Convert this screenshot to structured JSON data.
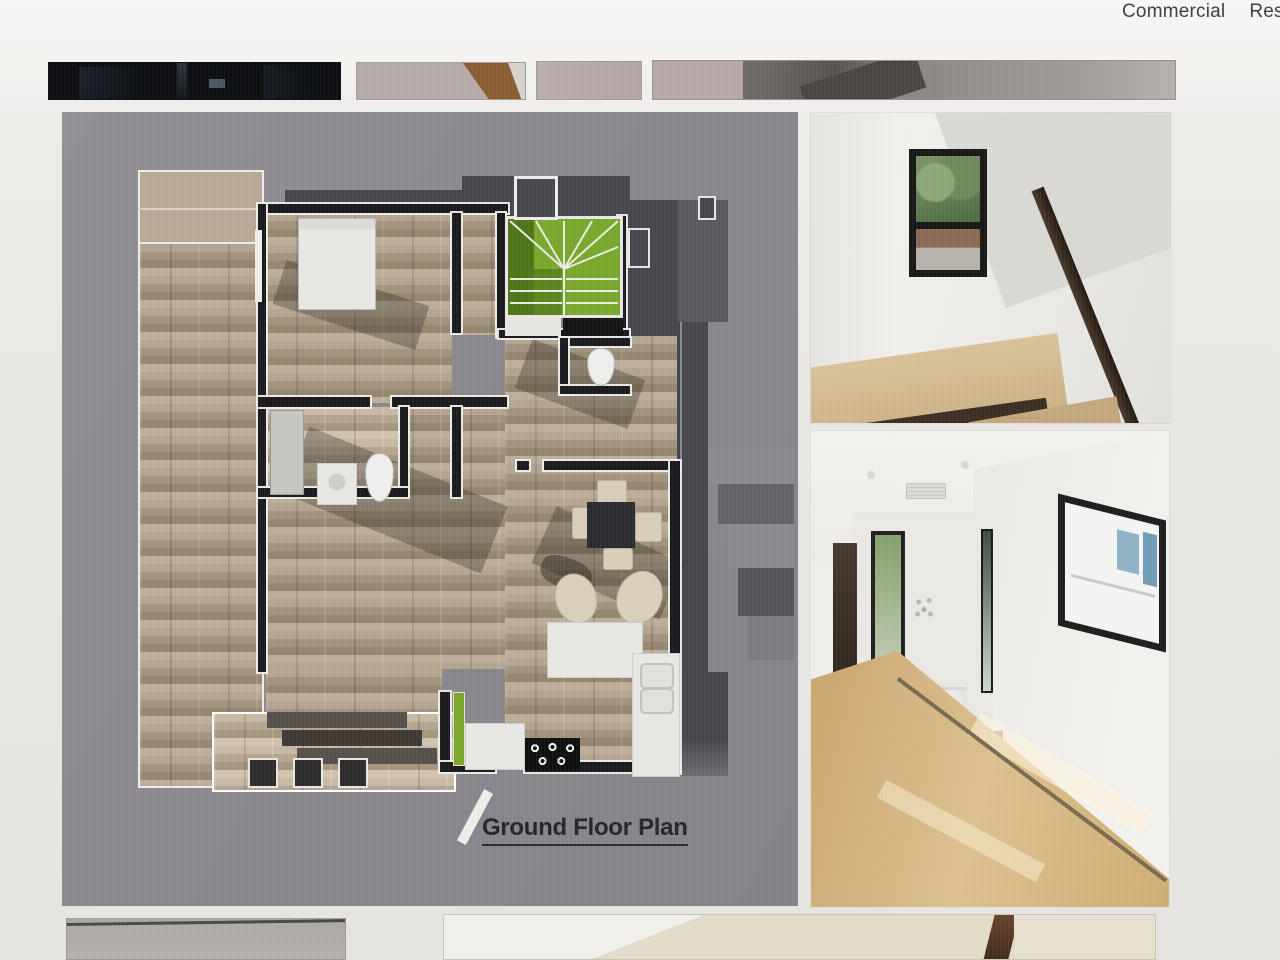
{
  "nav": {
    "items": [
      {
        "label": "Commercial"
      },
      {
        "label": "Res"
      }
    ]
  },
  "plan": {
    "title": "Ground Floor Plan"
  },
  "colors": {
    "page_bg": "#e9e7e3",
    "masthead_bg": "#f6f5f2",
    "nav_text": "#3e3e3e",
    "plan_panel_bg": "#8b888e",
    "roof_charcoal": "#46474c",
    "wood_floor": "#a79983",
    "stair_green": "#7aa82c",
    "wall_dark": "#1b1b1d",
    "wall_white": "#efedea",
    "hall_floor_wood": "#c9a26a"
  }
}
